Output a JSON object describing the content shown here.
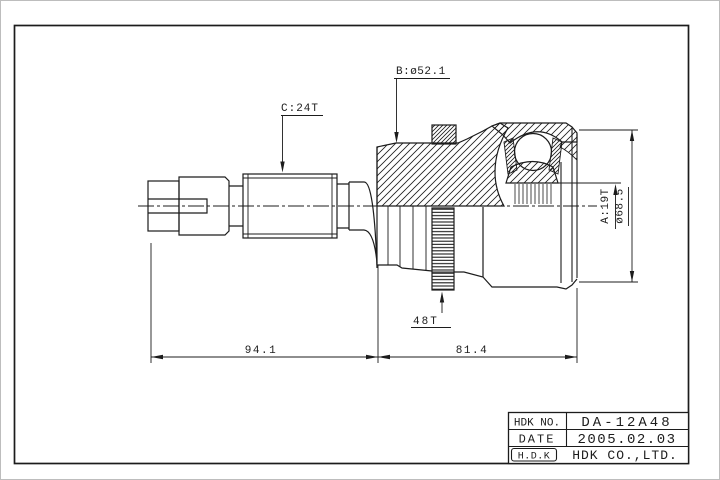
{
  "colors": {
    "ink": "#1c1c1c",
    "paper": "#ffffff",
    "page_edge": "#bdbdbd"
  },
  "callouts": {
    "spline_b": "B:ø52.1",
    "spline_c": "C:24T",
    "tone_ring": "48T",
    "spline_a": "A:19T",
    "outer_diameter": "ø68.5"
  },
  "dimensions": {
    "shaft_length": "94.1",
    "joint_length": "81.4"
  },
  "title_block": {
    "no_label": "HDK NO.",
    "no_value": "DA-12A48",
    "date_label": "DATE",
    "date_value": "2005.02.03",
    "logo": "H.D.K",
    "company": "HDK CO.,LTD."
  }
}
